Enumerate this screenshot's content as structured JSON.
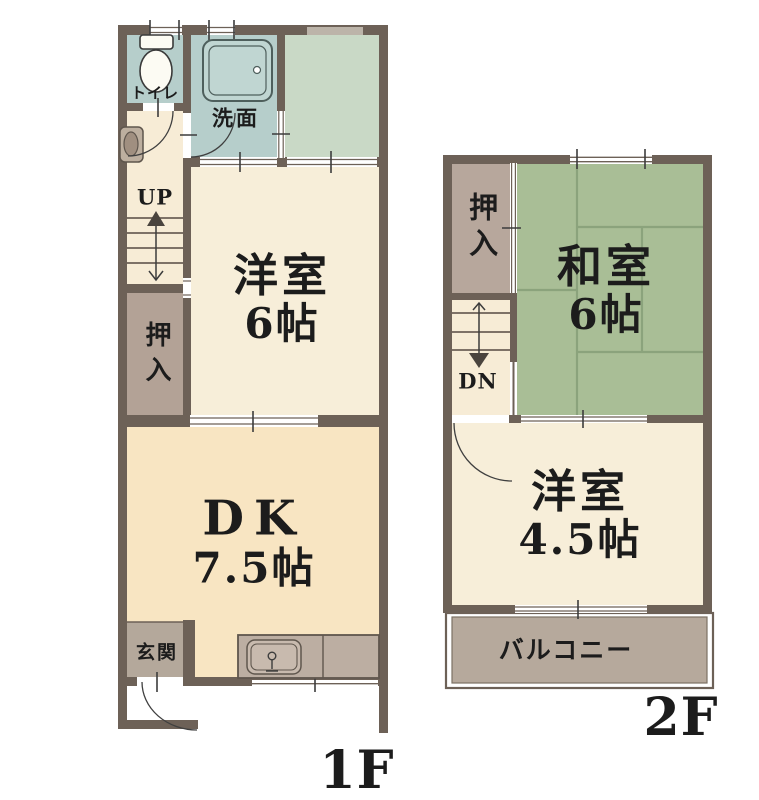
{
  "floors": [
    {
      "floor_label": "1F",
      "stair_label": "UP",
      "rooms": [
        {
          "name": "トイレ"
        },
        {
          "name": "洗面"
        },
        {
          "name": "洋室",
          "size": "6帖"
        },
        {
          "name": "押入"
        },
        {
          "name": "DK",
          "size": "7.5帖"
        },
        {
          "name": "玄関"
        }
      ]
    },
    {
      "floor_label": "2F",
      "stair_label": "DN",
      "rooms": [
        {
          "name": "押入"
        },
        {
          "name": "和室",
          "size": "6帖"
        },
        {
          "name": "洋室",
          "size": "4.5帖"
        },
        {
          "name": "バルコニー"
        }
      ]
    }
  ],
  "colors": {
    "wall": "#6d6157",
    "room_cream": "#f7eed9",
    "dk_cream": "#f8e5c2",
    "hall_cream": "#f7ecd6",
    "wet_area_teal": "#b6cecb",
    "bathtub": "#c0d6d2",
    "green_room": "#c9d9c6",
    "tatami": "#a9be96",
    "tatami_line": "#8ba37c",
    "closet_brown": "#b3a296",
    "genkan_brown": "#b4a89b",
    "balcony_brown": "#b6a99c",
    "counter_gray": "#bcaea2",
    "text": "#1c1c1c"
  }
}
